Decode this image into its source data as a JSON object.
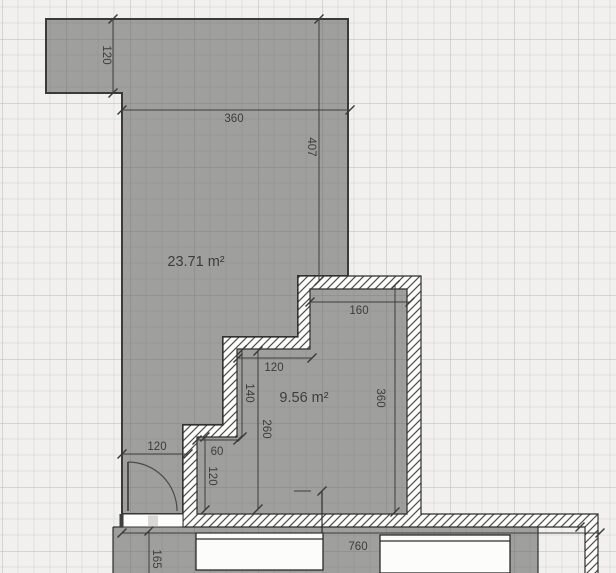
{
  "app": {
    "view": "floor-plan-canvas"
  },
  "canvas": {
    "width": 616,
    "height": 573,
    "background": "#f1f0ee",
    "grid_minor_color": "#e0dfdd",
    "grid_major_color": "#c5c4c2",
    "room_fill": "#9b9a99",
    "hatch_color": "#4e4e4e",
    "line_color": "#3e3e3e"
  },
  "rooms": [
    {
      "id": "large-room",
      "area_label": "23.71 m²"
    },
    {
      "id": "small-room",
      "area_label": "9.56 m²"
    }
  ],
  "dimensions": [
    {
      "id": "extension-height",
      "value": "120",
      "orientation": "vertical"
    },
    {
      "id": "top-width",
      "value": "360",
      "orientation": "horizontal"
    },
    {
      "id": "right-height",
      "value": "407",
      "orientation": "vertical"
    },
    {
      "id": "small-room-top",
      "value": "160",
      "orientation": "horizontal"
    },
    {
      "id": "step-width",
      "value": "120",
      "orientation": "horizontal"
    },
    {
      "id": "step-height",
      "value": "140",
      "orientation": "vertical"
    },
    {
      "id": "small-room-left",
      "value": "260",
      "orientation": "vertical"
    },
    {
      "id": "small-room-right",
      "value": "360",
      "orientation": "vertical"
    },
    {
      "id": "nook-width",
      "value": "60",
      "orientation": "horizontal"
    },
    {
      "id": "nook-height",
      "value": "120",
      "orientation": "vertical"
    },
    {
      "id": "door-wall-width",
      "value": "120",
      "orientation": "horizontal"
    },
    {
      "id": "bottom-width",
      "value": "760",
      "orientation": "horizontal"
    },
    {
      "id": "bottom-left-height",
      "value": "165",
      "orientation": "vertical"
    }
  ]
}
